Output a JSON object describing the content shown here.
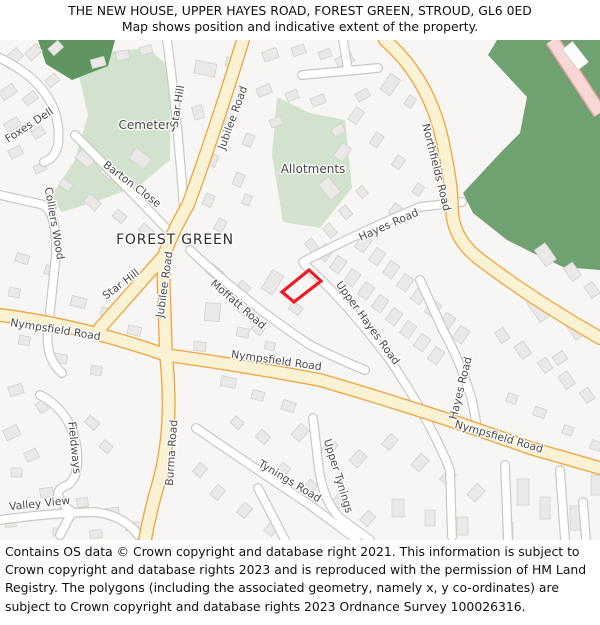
{
  "header": {
    "title": "THE NEW HOUSE, UPPER HAYES ROAD, FOREST GREEN, STROUD, GL6 0ED",
    "subtitle": "Map shows position and indicative extent of the property."
  },
  "footer": {
    "text": "Contains OS data © Crown copyright and database right 2021. This information is subject to Crown copyright and database rights 2023 and is reproduced with the permission of HM Land Registry. The polygons (including the associated geometry, namely x, y co-ordinates) are subject to Crown copyright and database rights 2023 Ordnance Survey 100026316."
  },
  "map": {
    "property_outline_color": "#ED1C24",
    "colors": {
      "woodland": "#6FA171",
      "greenspace": "#D3E2CE",
      "road_yellow_fill": "#FBF1D3",
      "road_yellow_casing": "#F0A33C",
      "road_pink_fill": "#F8D8D7",
      "background": "#F7F6F4"
    },
    "labels": [
      {
        "id": "foxes-dell",
        "text": "Foxes Dell"
      },
      {
        "id": "cemetery",
        "text": "Cemetery"
      },
      {
        "id": "star-hill-north",
        "text": "Star Hill"
      },
      {
        "id": "jubilee-road-north",
        "text": "Jubilee Road"
      },
      {
        "id": "northfields-road",
        "text": "Northfields Road"
      },
      {
        "id": "barton-close",
        "text": "Barton Close"
      },
      {
        "id": "colliers-wood",
        "text": "Colliers Wood"
      },
      {
        "id": "allotments",
        "text": "Allotments"
      },
      {
        "id": "hayes-road-upper",
        "text": "Hayes Road"
      },
      {
        "id": "forest-green",
        "text": "FOREST GREEN"
      },
      {
        "id": "star-hill-south",
        "text": "Star Hill"
      },
      {
        "id": "jubilee-road-south",
        "text": "Jubilee Road"
      },
      {
        "id": "moffatt-road",
        "text": "Moffatt Road"
      },
      {
        "id": "nympsfield-road-west",
        "text": "Nympsfield Road"
      },
      {
        "id": "nympsfield-road-center",
        "text": "Nympsfield Road"
      },
      {
        "id": "upper-hayes-road",
        "text": "Upper Hayes Road"
      },
      {
        "id": "hayes-road-south",
        "text": "Hayes Road"
      },
      {
        "id": "nympsfield-road-east",
        "text": "Nympsfield Road"
      },
      {
        "id": "fieldways",
        "text": "Fieldways"
      },
      {
        "id": "burma-road",
        "text": "Burma Road"
      },
      {
        "id": "valley-view",
        "text": "Valley View"
      },
      {
        "id": "tynings-road",
        "text": "Tynings Road"
      },
      {
        "id": "upper-tynings",
        "text": "Upper Tynings"
      }
    ]
  }
}
